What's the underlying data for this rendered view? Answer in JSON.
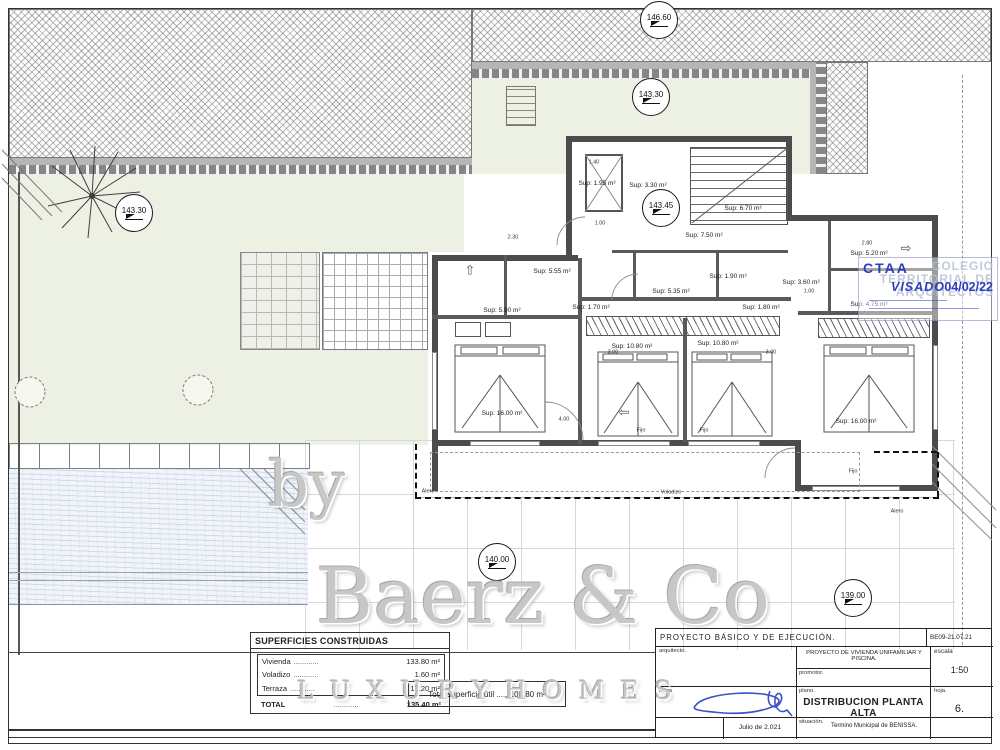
{
  "watermark": {
    "by": "by",
    "brand": "Baerz & Co",
    "tagline": "L U X U R Y   H O M E S"
  },
  "stamp": {
    "org": "CTAA",
    "bg_line1": "COLEGIO",
    "bg_line2": "TERRITORIAL DE",
    "bg_line3": "ARQUITECTOS",
    "status": "VISADO",
    "date": "04/02/22"
  },
  "areas_table": {
    "title": "SUPERFICIES CONSTRUIDAS",
    "dots": "............",
    "rows": [
      {
        "label": "Vivienda",
        "value": "133.80 m²"
      },
      {
        "label": "Voladizo",
        "value": "1.60 m²"
      },
      {
        "label": "Terraza",
        "value": "17.20 m²"
      }
    ],
    "total_label": "TOTAL",
    "total_value": "135.40 m²"
  },
  "useful_area_note": "Total superficie útil ..... 108.80 m²",
  "title_block": {
    "project_row": "PROYECTO BÁSICO Y DE EJECUCIÓN.",
    "code": "BE09-21.07.21",
    "arquitecto_label": "arquitecto.",
    "obra": "PROYECTO DE VIVIENDA UNIFAMILIAR Y PISCINA.",
    "promotor_label": "promotor.",
    "escala_label": "escala",
    "escala_value": "1:50",
    "firma_label": "firma",
    "plano_label": "plano.",
    "plano_value": "DISTRIBUCION PLANTA ALTA",
    "hoja_label": "hoja.",
    "hoja_value": "6.",
    "situacion_label": "situación.",
    "situacion_value": "Termino Municipal de BENISSA.",
    "fecha": "Julio de 2.021"
  },
  "annotations": {
    "elevation_markers": [
      {
        "text": "146.60",
        "x": 659,
        "y": 20
      },
      {
        "text": "143.30",
        "x": 651,
        "y": 97
      },
      {
        "text": "143.30",
        "x": 134,
        "y": 213
      },
      {
        "text": "143.45",
        "x": 661,
        "y": 208
      },
      {
        "text": "140.00",
        "x": 497,
        "y": 562
      },
      {
        "text": "139.00",
        "x": 853,
        "y": 598
      }
    ],
    "room_labels": [
      {
        "text": "Sup: 1.95 m²",
        "x": 597,
        "y": 184
      },
      {
        "text": "Sup: 3.30 m²",
        "x": 648,
        "y": 186
      },
      {
        "text": "Sup: 6.70 m²",
        "x": 743,
        "y": 209
      },
      {
        "text": "Sup: 7.50 m²",
        "x": 704,
        "y": 236
      },
      {
        "text": "Sup: 5.55 m²",
        "x": 552,
        "y": 272
      },
      {
        "text": "Sup: 5.35 m²",
        "x": 671,
        "y": 292
      },
      {
        "text": "Sup: 1.90 m²",
        "x": 728,
        "y": 277
      },
      {
        "text": "Sup: 5.90 m²",
        "x": 502,
        "y": 311
      },
      {
        "text": "Sup: 1.70 m²",
        "x": 591,
        "y": 308
      },
      {
        "text": "Sup: 1.80 m²",
        "x": 761,
        "y": 308
      },
      {
        "text": "Sup: 10.80 m²",
        "x": 632,
        "y": 347
      },
      {
        "text": "Sup: 10.80 m²",
        "x": 718,
        "y": 344
      },
      {
        "text": "Sup: 16.00 m²",
        "x": 502,
        "y": 414
      },
      {
        "text": "Sup: 16.00 m²",
        "x": 856,
        "y": 422
      },
      {
        "text": "Sup: 5.20 m²",
        "x": 869,
        "y": 254
      },
      {
        "text": "Sup: 3.60 m²",
        "x": 801,
        "y": 283
      },
      {
        "text": "Sup: 4.75 m²",
        "x": 869,
        "y": 305
      }
    ],
    "dim_labels": [
      {
        "text": "2.30",
        "x": 513,
        "y": 238
      },
      {
        "text": "1.40",
        "x": 594,
        "y": 163
      },
      {
        "text": "4.65",
        "x": 662,
        "y": 226
      },
      {
        "text": "1.00",
        "x": 600,
        "y": 224
      },
      {
        "text": "3.00",
        "x": 613,
        "y": 353
      },
      {
        "text": "3.00",
        "x": 771,
        "y": 353
      },
      {
        "text": "4.00",
        "x": 564,
        "y": 420
      },
      {
        "text": "1.00",
        "x": 809,
        "y": 292
      },
      {
        "text": "2.80",
        "x": 867,
        "y": 244
      }
    ],
    "window_labels": [
      {
        "text": "Fijo",
        "x": 641,
        "y": 431
      },
      {
        "text": "Fijo",
        "x": 704,
        "y": 431
      },
      {
        "text": "Fijo",
        "x": 853,
        "y": 472
      }
    ],
    "eave_labels": [
      {
        "text": "Alero",
        "x": 428,
        "y": 492
      },
      {
        "text": "Voladizo",
        "x": 671,
        "y": 493
      },
      {
        "text": "Alero",
        "x": 897,
        "y": 512
      }
    ],
    "arrows": [
      {
        "glyph": "⇧",
        "x": 470,
        "y": 270
      },
      {
        "glyph": "⇨",
        "x": 906,
        "y": 248
      },
      {
        "glyph": "⇦",
        "x": 624,
        "y": 412
      }
    ]
  }
}
